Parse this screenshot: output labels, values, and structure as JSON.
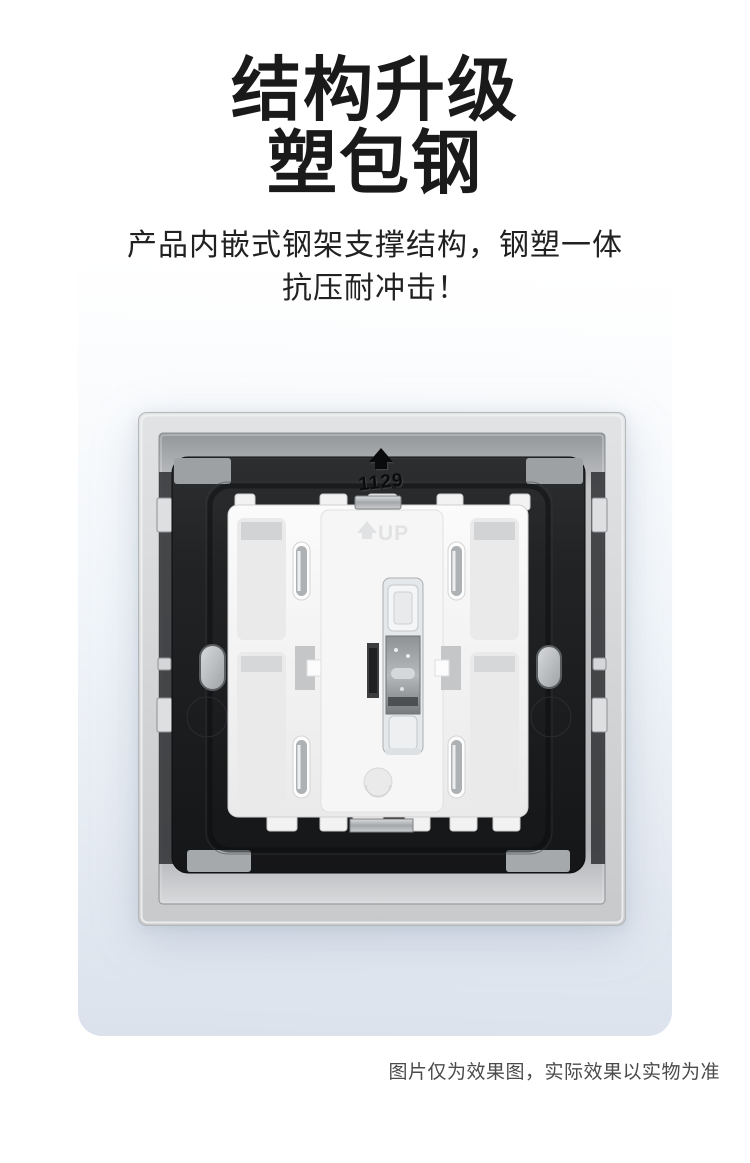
{
  "page": {
    "background_color": "#ffffff",
    "card_gradient_top": "#ffffff",
    "card_gradient_bottom": "#dbe2ec"
  },
  "header": {
    "title_line1": "结构升级",
    "title_line2": "塑包钢",
    "subtitle_line1": "产品内嵌式钢架支撑结构，钢塑一体",
    "subtitle_line2": "抗压耐冲击！"
  },
  "product": {
    "plate_code": "1129",
    "up_label": "UP",
    "colors": {
      "frame_silver": "#d2d4d6",
      "plate_black": "#1d1f21",
      "module_white": "#f3f3f3",
      "rocker_clear": "#e5e8ea"
    }
  },
  "footer": {
    "disclaimer": "图片仅为效果图，实际效果以实物为准"
  }
}
